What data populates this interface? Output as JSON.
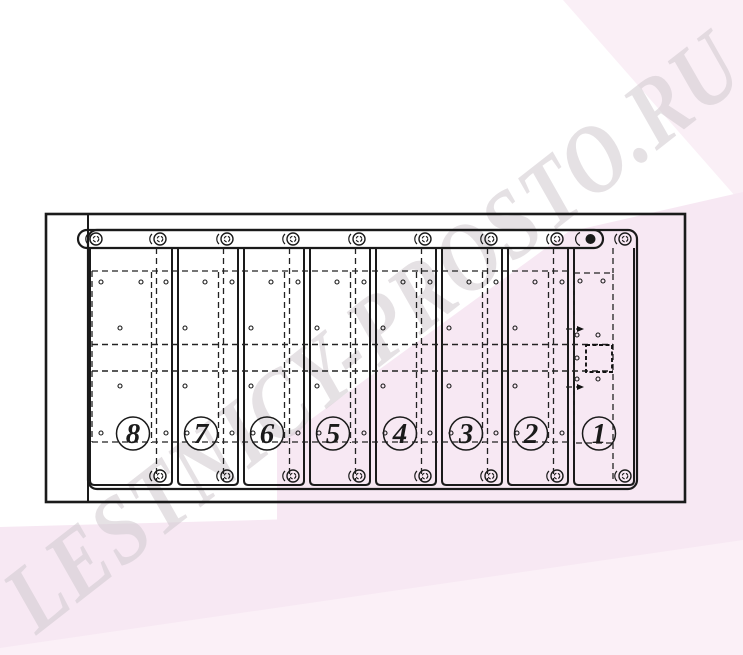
{
  "watermark": {
    "text": "LESTNICY-PROSTO.RU"
  },
  "colors": {
    "background": "#ffffff",
    "pink": "#f7e8f3",
    "pink_light": "#fbf0f7",
    "pink_soft": "#faeff6",
    "line": "#1a1a1a",
    "watermark": "#cfc8ce"
  },
  "drawing": {
    "type": "technical-diagram",
    "description": "Top view drawing of a staircase step assembly with eight numbered vertical step panels, a top mounting rail with washer fasteners, and hidden-outline dashed bands",
    "frame": [
      46,
      214,
      639,
      288
    ],
    "plate": [
      88,
      230,
      549,
      259
    ],
    "rail": [
      78,
      230,
      525,
      18
    ],
    "band_lines_y": [
      271,
      344.5,
      371,
      442
    ],
    "band_span_x": [
      92,
      613
    ],
    "strip_bottom_y": 485,
    "rail_fastener_x": 96,
    "fastener_rows_y": {
      "top": 239,
      "bottom": 476
    },
    "panels": [
      {
        "label": "8",
        "strip": [
          90,
          172
        ],
        "pair_x": 154,
        "fastener_x": 160,
        "number_cx": 133,
        "holes": [
          [
            101,
            282
          ],
          [
            141,
            282
          ],
          [
            166,
            282
          ],
          [
            120,
            328
          ],
          [
            120,
            386
          ],
          [
            101,
            433
          ],
          [
            166,
            433
          ]
        ]
      },
      {
        "label": "7",
        "strip": [
          178,
          238
        ],
        "pair_x": 221,
        "fastener_x": 227,
        "number_cx": 201,
        "holes": [
          [
            205,
            282
          ],
          [
            232,
            282
          ],
          [
            185,
            328
          ],
          [
            185,
            386
          ],
          [
            187,
            433
          ],
          [
            232,
            433
          ]
        ]
      },
      {
        "label": "6",
        "strip": [
          244,
          304
        ],
        "pair_x": 287,
        "fastener_x": 293,
        "number_cx": 267,
        "holes": [
          [
            271,
            282
          ],
          [
            298,
            282
          ],
          [
            251,
            328
          ],
          [
            251,
            386
          ],
          [
            253,
            433
          ],
          [
            298,
            433
          ]
        ]
      },
      {
        "label": "5",
        "strip": [
          310,
          370
        ],
        "pair_x": 353,
        "fastener_x": 359,
        "number_cx": 333,
        "holes": [
          [
            337,
            282
          ],
          [
            364,
            282
          ],
          [
            317,
            328
          ],
          [
            317,
            386
          ],
          [
            319,
            433
          ],
          [
            364,
            433
          ]
        ]
      },
      {
        "label": "4",
        "strip": [
          376,
          436
        ],
        "pair_x": 419,
        "fastener_x": 425,
        "number_cx": 400,
        "holes": [
          [
            403,
            282
          ],
          [
            430,
            282
          ],
          [
            383,
            328
          ],
          [
            383,
            386
          ],
          [
            385,
            433
          ],
          [
            430,
            433
          ]
        ]
      },
      {
        "label": "3",
        "strip": [
          442,
          502
        ],
        "pair_x": 485,
        "fastener_x": 491,
        "number_cx": 466,
        "holes": [
          [
            469,
            282
          ],
          [
            496,
            282
          ],
          [
            449,
            328
          ],
          [
            449,
            386
          ],
          [
            451,
            433
          ],
          [
            496,
            433
          ]
        ]
      },
      {
        "label": "2",
        "strip": [
          508,
          568
        ],
        "pair_x": 551,
        "fastener_x": 557,
        "number_cx": 531,
        "holes": [
          [
            535,
            282
          ],
          [
            562,
            282
          ],
          [
            515,
            328
          ],
          [
            515,
            386
          ],
          [
            517,
            433
          ],
          [
            562,
            433
          ]
        ]
      },
      {
        "label": "1",
        "strip": [
          574,
          634
        ],
        "pair_x": null,
        "fastener_x": 625,
        "number_cx": 599,
        "holes": [
          [
            580,
            281
          ],
          [
            603,
            281
          ],
          [
            577,
            335
          ],
          [
            598,
            335
          ],
          [
            577,
            358
          ],
          [
            577,
            379
          ],
          [
            598,
            379
          ]
        ],
        "dashed_rect": [
          574,
          273,
          39,
          170
        ],
        "inner_box": [
          586,
          345,
          26,
          27
        ],
        "arrows_y": [
          329,
          387
        ]
      }
    ]
  }
}
